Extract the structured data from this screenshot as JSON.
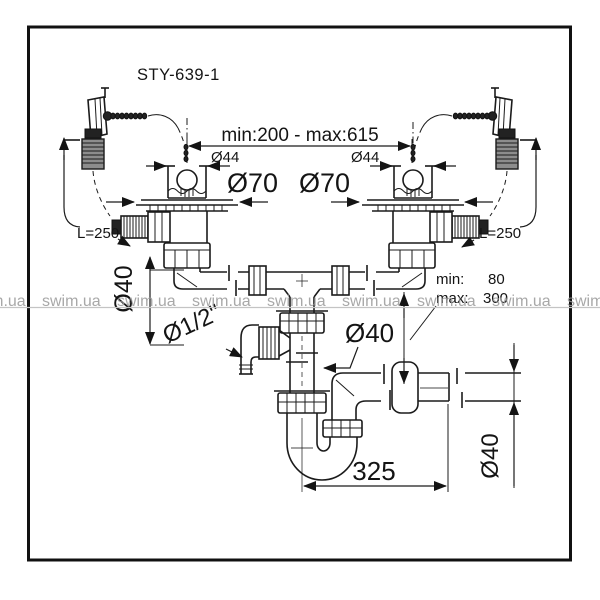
{
  "title": "STY-639-1",
  "watermark": {
    "text": "swim.ua",
    "color": "#999999"
  },
  "labels": {
    "span_minmax": "min:200 - max:615",
    "left_drain_diameter": "Ø44",
    "right_drain_diameter": "Ø44",
    "left_flange_diameter": "Ø70",
    "right_flange_diameter": "Ø70",
    "left_overflow_length": "L=250",
    "right_overflow_length": "L=250",
    "left_pipe_diameter": "Ø40",
    "appliance_connection": "Ø1/2\"",
    "drop_pipe_diameter": "Ø40",
    "outlet_min_label": "min:",
    "outlet_min_value": "80",
    "outlet_max_label": "max:",
    "outlet_max_value": "300",
    "trap_offset": "325",
    "outlet_pipe_diameter": "Ø40"
  }
}
